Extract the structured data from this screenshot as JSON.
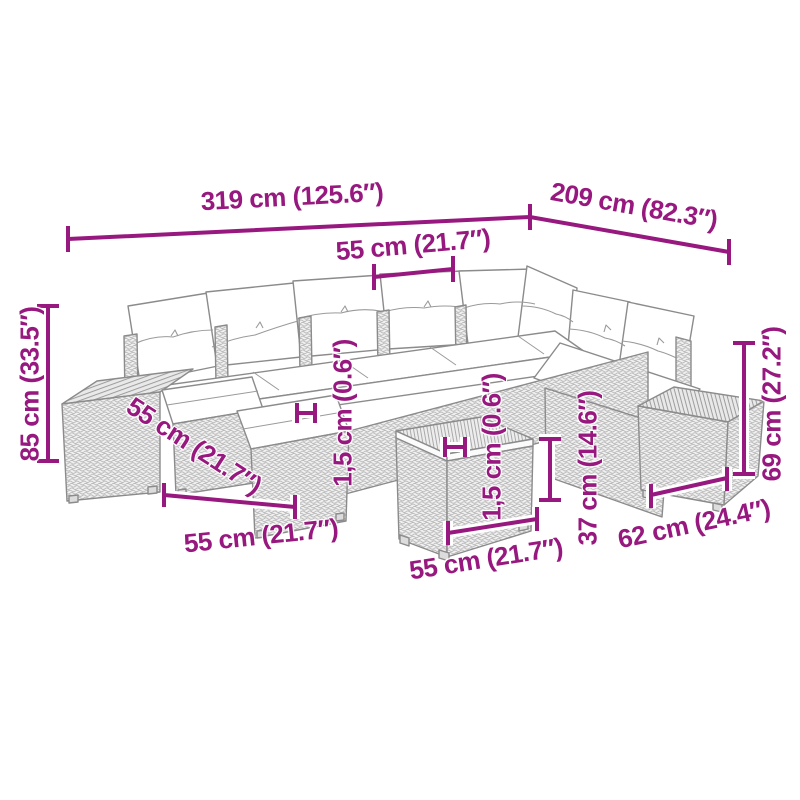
{
  "diagram": {
    "kind": "furniture dimension drawing",
    "illustration": "L-shaped poly rattan garden lounge set: corner sofa with white back and seat cushions, two ottoman stools, two slat-top side tables and a cube coffee table",
    "colors": {
      "dimension_accent": "#97187E",
      "line_art": "#8b8b8b",
      "background": "#ffffff"
    }
  },
  "labels": {
    "total_width": "319 cm (125.6″)",
    "total_depth": "209 cm (82.3″)",
    "seat_width": "55 cm (21.7″)",
    "overall_height": "85 cm (33.5″)",
    "ottoman_width_diagonal": "55 cm (21.7″)",
    "ottoman_width_bottom": "55 cm (21.7″)",
    "cushion_thickness": "1,5 cm (0.6″)",
    "tabletop_thickness": "1,5 cm (0.6″)",
    "table_height": "37 cm (14.6″)",
    "table_width": "55 cm (21.7″)",
    "side_table_width": "62 cm (24.4″)",
    "side_table_height": "69 cm (27.2″)"
  }
}
